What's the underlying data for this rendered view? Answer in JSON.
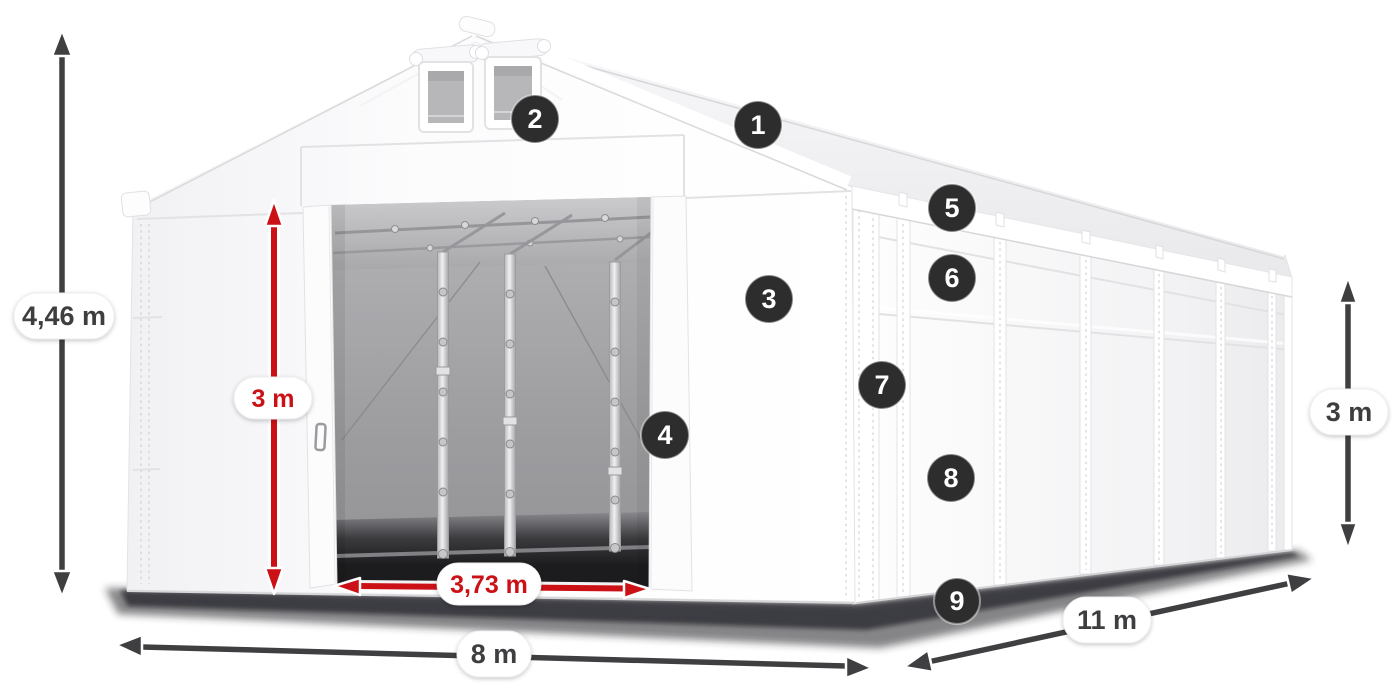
{
  "figure": {
    "type": "product-dimension-diagram",
    "subject": "White storage tent with open sliding door, numbered feature markers and size annotations"
  },
  "colors": {
    "background": "#ffffff",
    "tent": "#ffffff",
    "dimension_red": "#cb1116",
    "dimension_dark": "#3f3f41",
    "badge_background": "#2d2d2e",
    "badge_text": "#ffffff",
    "interior_gray": "#9d9da0"
  },
  "feature_badges": [
    "1",
    "2",
    "3",
    "4",
    "5",
    "6",
    "7",
    "8",
    "9"
  ],
  "dimensions": {
    "total_height": {
      "label": "4,46 m"
    },
    "door_height": {
      "label": "3 m"
    },
    "door_clear_width": {
      "label": "3,73 m"
    },
    "front_width": {
      "label": "8 m"
    },
    "side_length": {
      "label": "11 m"
    },
    "side_wall_height": {
      "label": "3 m"
    }
  }
}
